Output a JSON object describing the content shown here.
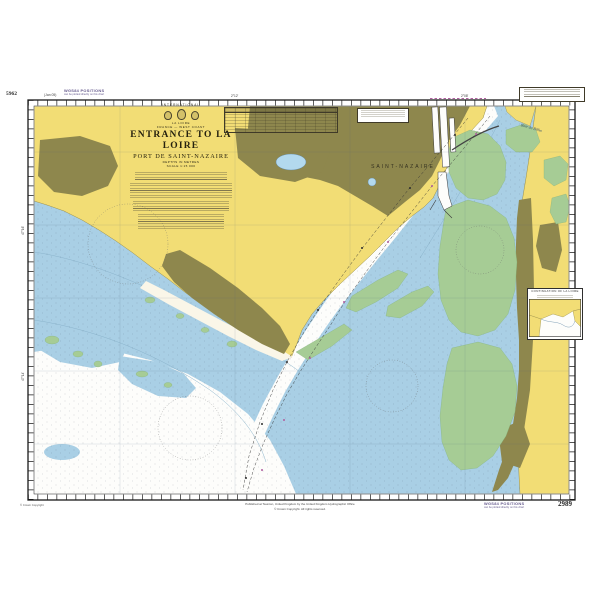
{
  "colors": {
    "land": "#f2dd75",
    "urban": "#8e874d",
    "intertidal": "#a6cc95",
    "shallow_water": "#a9cfe5",
    "deep_water": "#fdfdfb",
    "lake": "#b3d9ee",
    "wgs84_text": "#655a8d",
    "ink": "#222222"
  },
  "margins": {
    "adjacent_chart_number": "5962",
    "edition_date": "(Jan 05)",
    "wgs84_title": "WGS84 POSITIONS",
    "wgs84_subtitle": "can be plotted directly on this chart",
    "chart_number": "2989",
    "copyright_note": "© Crown Copyright",
    "publication_line1": "Published at Taunton, United Kingdom by the United Kingdom Hydrographic Office",
    "publication_line2": "© Crown Copyright. All rights reserved."
  },
  "title_block": {
    "international": "INTERNATIONAL",
    "series": "LA LOIRE",
    "region": "FRANCE — WEST COAST",
    "title": "ENTRANCE TO LA LOIRE",
    "subtitle": "PORT DE SAINT-NAZAIRE",
    "depths_note": "DEPTHS IN METRES",
    "scale_note": "SCALE 1:15 000"
  },
  "map_labels": {
    "city": "SAINT-NAZAIRE",
    "bay": "Baie de Bilho"
  },
  "inset": {
    "title": "CONTINUATION OF LA LOIRE"
  },
  "graticule": {
    "top": [
      "2°12'",
      "2°08'"
    ],
    "left": [
      "47°16'",
      "47°14'"
    ]
  }
}
